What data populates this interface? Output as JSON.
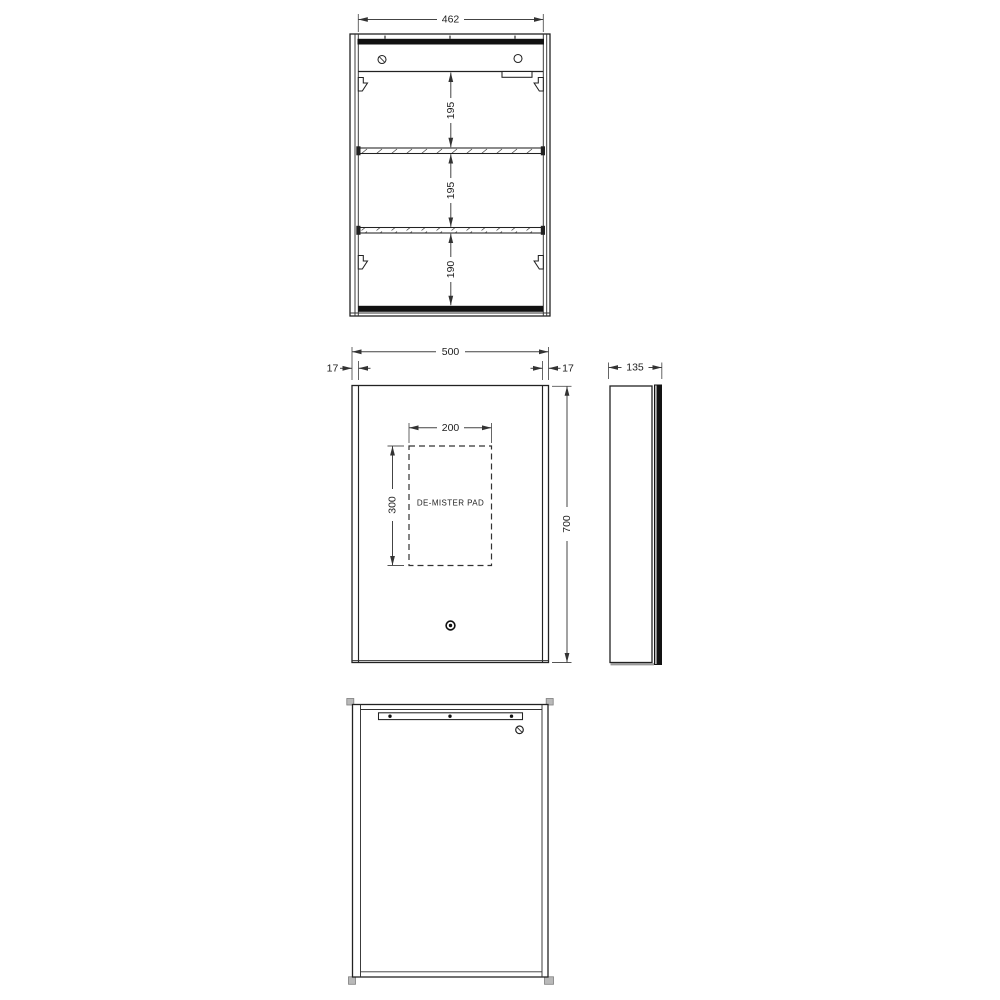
{
  "drawing": {
    "type": "technical-drawing",
    "subject": "mirror cabinet with de-mister pad",
    "line_color": "#222222",
    "background_color": "#ffffff"
  },
  "views": {
    "internal_front": {
      "dims": {
        "internal_width": "462",
        "shelf_space_top": "195",
        "shelf_space_middle": "195",
        "shelf_space_bottom": "190"
      }
    },
    "front": {
      "dims": {
        "overall_width": "500",
        "door_offset_left": "17",
        "door_offset_right": "17",
        "pad_width": "200",
        "pad_height": "300",
        "overall_height": "700"
      },
      "labels": {
        "demister_pad": "DE-MISTER PAD"
      }
    },
    "side": {
      "dims": {
        "depth": "135"
      }
    },
    "back": {}
  }
}
